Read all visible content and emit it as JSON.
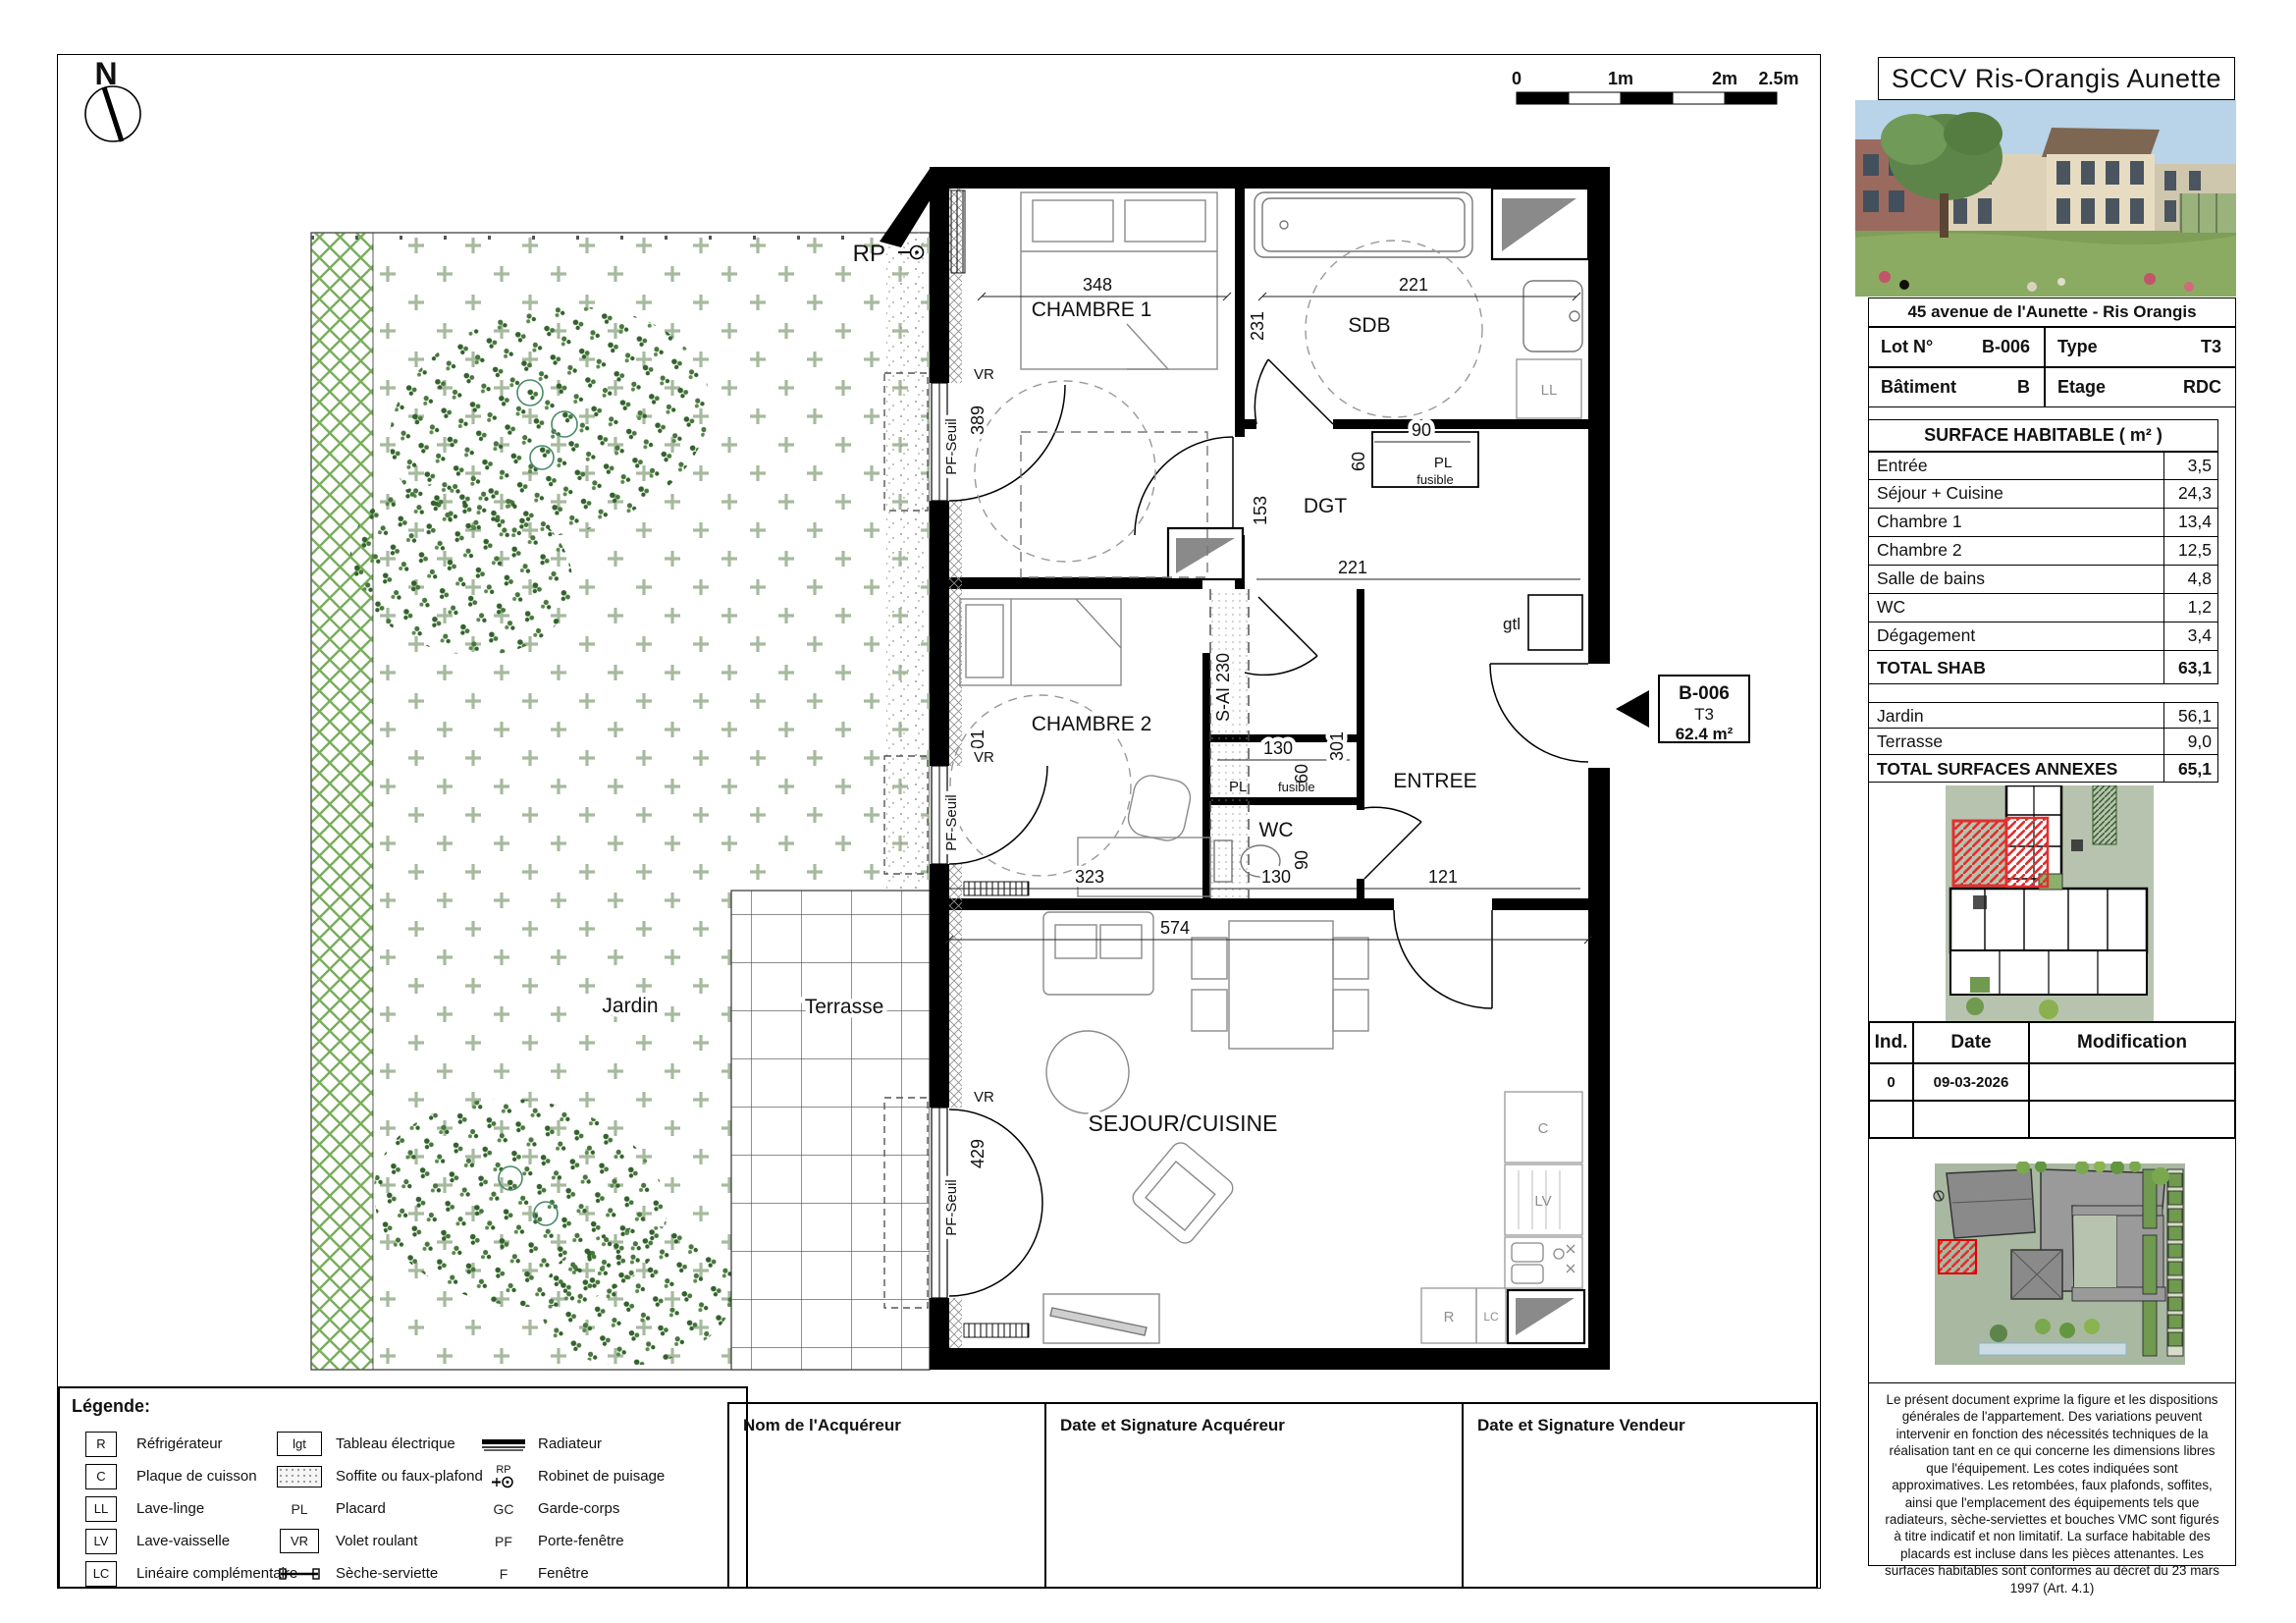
{
  "title_block": {
    "company": "SCCV Ris-Orangis Aunette",
    "address": "45 avenue de l'Aunette - Ris Orangis",
    "lot_label": "Lot N°",
    "lot_value": "B-006",
    "type_label": "Type",
    "type_value": "T3",
    "batiment_label": "Bâtiment",
    "batiment_value": "B",
    "etage_label": "Etage",
    "etage_value": "RDC"
  },
  "surface_table": {
    "header": "SURFACE HABITABLE ( m² )",
    "rows": [
      {
        "label": "Entrée",
        "value": "3,5"
      },
      {
        "label": "Séjour + Cuisine",
        "value": "24,3"
      },
      {
        "label": "Chambre 1",
        "value": "13,4"
      },
      {
        "label": "Chambre 2",
        "value": "12,5"
      },
      {
        "label": "Salle de bains",
        "value": "4,8"
      },
      {
        "label": "WC",
        "value": "1,2"
      },
      {
        "label": "Dégagement",
        "value": "3,4"
      }
    ],
    "total_label": "TOTAL SHAB",
    "total_value": "63,1"
  },
  "annex_table": {
    "rows": [
      {
        "label": "Jardin",
        "value": "56,1"
      },
      {
        "label": "Terrasse",
        "value": "9,0"
      }
    ],
    "total_label": "TOTAL SURFACES ANNEXES",
    "total_value": "65,1"
  },
  "revision_table": {
    "headers": [
      "Ind.",
      "Date",
      "Modification"
    ],
    "rows": [
      {
        "ind": "0",
        "date": "09-03-2026",
        "modification": ""
      }
    ]
  },
  "disclaimer": "Le présent document exprime la figure et les dispositions générales de l'appartement. Des variations peuvent intervenir en fonction des nécessités techniques de la réalisation tant en ce qui concerne les dimensions libres que l'équipement. Les cotes indiquées sont approximatives. Les retombées, faux plafonds, soffites, ainsi que l'emplacement des équipements tels que radiateurs, sèche-serviettes et bouches VMC sont figurés à titre indicatif et non limitatif. La surface habitable des placards est incluse dans les pièces attenantes. Les surfaces habitables sont conformes au décret du 23 mars 1997 (Art. 4.1)",
  "signatures": {
    "buyer_name_label": "Nom de l'Acquéreur",
    "buyer_sign_label": "Date et Signature Acquéreur",
    "vendor_sign_label": "Date et Signature Vendeur"
  },
  "legend": {
    "title": "Légende:",
    "col1": [
      {
        "symbol": "R",
        "label": "Réfrigérateur"
      },
      {
        "symbol": "C",
        "label": "Plaque de cuisson"
      },
      {
        "symbol": "LL",
        "label": "Lave-linge"
      },
      {
        "symbol": "LV",
        "label": "Lave-vaisselle"
      },
      {
        "symbol": "LC",
        "label": "Linéaire complémentaire"
      }
    ],
    "col2": [
      {
        "symbol": "lgt",
        "label": "Tableau électrique"
      },
      {
        "symbol": "",
        "label": "Soffite ou faux-plafond"
      },
      {
        "symbol": "PL",
        "label": "Placard"
      },
      {
        "symbol": "VR",
        "label": "Volet roulant"
      },
      {
        "symbol": "",
        "label": "Sèche-serviette"
      }
    ],
    "col3": [
      {
        "symbol": "",
        "label": "Radiateur"
      },
      {
        "symbol": "RP",
        "label": "Robinet de puisage"
      },
      {
        "symbol": "GC",
        "label": "Garde-corps"
      },
      {
        "symbol": "PF",
        "label": "Porte-fenêtre"
      },
      {
        "symbol": "F",
        "label": "Fenêtre"
      }
    ]
  },
  "scale_bar": {
    "labels": [
      "0",
      "1m",
      "2m",
      "2.5m"
    ]
  },
  "north_label": "N",
  "plan": {
    "rooms": {
      "chambre1": "CHAMBRE 1",
      "sdb": "SDB",
      "dgt": "DGT",
      "chambre2": "CHAMBRE 2",
      "wc": "WC",
      "entree": "ENTREE",
      "sejour": "SEJOUR/CUISINE"
    },
    "labels": {
      "rp": "RP",
      "vr": "VR",
      "pf_seuil": "PF-Seuil",
      "soffite": "S-AI 230",
      "pl": "PL",
      "fusible": "fusible",
      "gtl": "gtl",
      "ll": "LL",
      "cooktop": "C",
      "lv": "LV",
      "fridge": "R",
      "lc": "LC",
      "jardin": "Jardin",
      "terrasse": "Terrasse"
    },
    "dims": {
      "chambre1_width": "348",
      "sdb_width": "221",
      "sdb_height": "231",
      "chambre1_window": "389",
      "dgt_placard_width": "90",
      "dgt_placard_depth": "60",
      "dgt_height": "153",
      "dgt_width": "221",
      "chambre2_window": "301",
      "pl_width": "130",
      "pl_depth": "60",
      "entree_height": "301",
      "chambre2_width": "323",
      "wc_width": "130",
      "wc_depth": "90",
      "entree_width": "121",
      "sejour_width": "574",
      "sejour_window": "429"
    },
    "unit_tag": {
      "lot": "B-006",
      "type": "T3",
      "area": "62.4 m²"
    },
    "colors": {
      "hedge": "#79AD5C",
      "grass_plus": "#A6BA9E",
      "highlight_red": "#E03030"
    }
  }
}
